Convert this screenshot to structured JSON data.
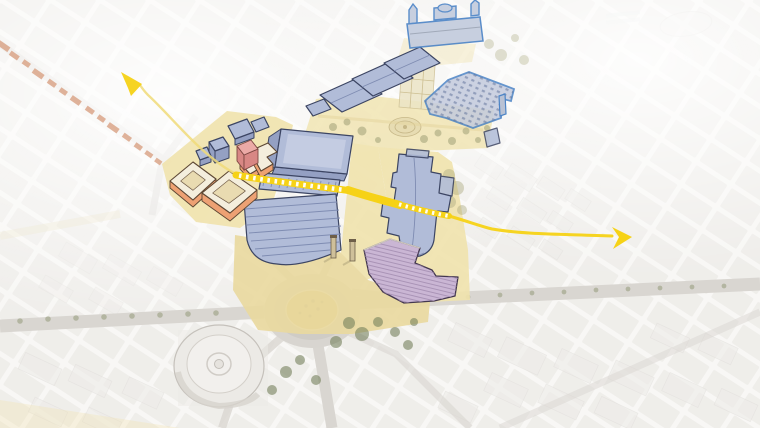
{
  "canvas": {
    "width": 760,
    "height": 428,
    "type": "aerial-axonometric-masterplan-diagram"
  },
  "palette": {
    "bg": "#f6f5f2",
    "photo-block": "#e8e6e2",
    "photo-edge": "#d9d6d1",
    "street": "#d9d6d1",
    "ground": "#f0e3ae",
    "ground-deep": "#ead9a0",
    "gold": "#d6bd74",
    "gold-dot": "#99874f",
    "hall": "#b1bcd8",
    "hall-light": "#c4cce2",
    "hall-line": "#7f8cb2",
    "hall-wall": "#94a0c3",
    "hall-outline": "#3c4563",
    "landmark": "#4c84c6",
    "landmark-fill": "#c3cbdd",
    "new-roof": "#f4eedd",
    "new-orange": "#eda173",
    "new-outline": "#5c4633",
    "band-orange": "#d9a183",
    "accent-red": "#d88784",
    "accent-red-top": "#ecaaa6",
    "accent-outline": "#7d4742",
    "purple-fill": "#cab6d4",
    "purple-hatch": "#a48eb1",
    "purple-outline": "#43374f",
    "route": "#f6d216",
    "route-pale": "#f0da79",
    "tree-olive": "#adab82",
    "tree-dark": "#76815c",
    "tree-row": "#8f9672",
    "column": "#cfc09a",
    "column-cap": "#6e5f49",
    "parterre": "#ece4c6",
    "parterre-line": "#cdbf92",
    "arena-fill": "#eceae6",
    "arena-edge": "#c5c1bb"
  },
  "layers": [
    {
      "name": "faded-aerial-basemap",
      "color": "#e8e6e2"
    },
    {
      "name": "public-ground-overlay",
      "color": "#f0e3ae"
    },
    {
      "name": "existing-halls-blue",
      "color": "#b1bcd8"
    },
    {
      "name": "landmark-buildings-blue-outline",
      "color": "#4c84c6"
    },
    {
      "name": "new-courtyard-blocks-orange",
      "color": "#eda173"
    },
    {
      "name": "accent-building-red",
      "color": "#d88784"
    },
    {
      "name": "hatched-building-purple",
      "color": "#cab6d4"
    },
    {
      "name": "street-band-orange",
      "color": "#d9a183"
    },
    {
      "name": "roundabout-garden-gold",
      "color": "#d6bd74"
    },
    {
      "name": "pedestrian-route-yellow",
      "color": "#f6d216"
    }
  ],
  "route": {
    "color": "#f6d216",
    "style": "solid-with-white-ladder-dashes-over-buildings",
    "arrowheads": [
      {
        "direction": "northwest"
      },
      {
        "direction": "east"
      }
    ]
  },
  "features": {
    "roundabout": {
      "center_fill": "#d6bd74",
      "ring_fill": "#d9d6d1"
    },
    "arena": {
      "shape": "circular",
      "fill": "#eceae6"
    },
    "monument_columns": {
      "count": 2,
      "fill": "#cfc09a"
    }
  }
}
